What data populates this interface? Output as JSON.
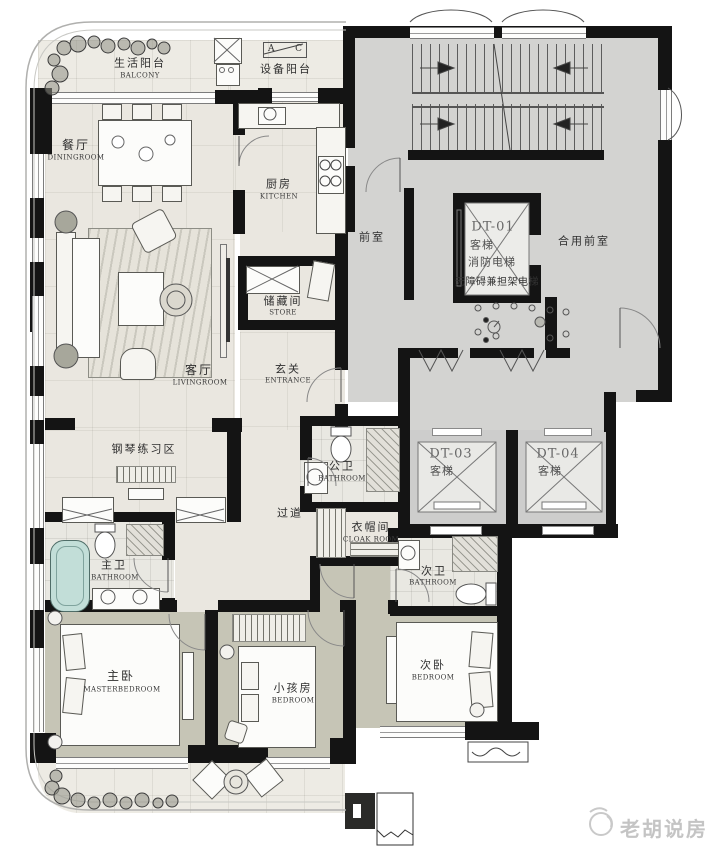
{
  "watermark": {
    "brand": "老胡说房"
  },
  "section_marker": {
    "left": "A",
    "right": "C"
  },
  "rooms": {
    "life_balcony": {
      "zh": "生活阳台",
      "en": "BALCONY"
    },
    "equipment_balcony": {
      "zh": "设备阳台"
    },
    "dining": {
      "zh": "餐厅",
      "en": "DININGROOM"
    },
    "kitchen": {
      "zh": "厨房",
      "en": "KITCHEN"
    },
    "front_room": {
      "zh": "前室"
    },
    "shared_front_room": {
      "zh": "合用前室"
    },
    "store": {
      "zh": "储藏间",
      "en": "STORE"
    },
    "living": {
      "zh": "客厅",
      "en": "LIVINGROOM"
    },
    "entrance": {
      "zh": "玄关",
      "en": "ENTRANCE"
    },
    "piano_area": {
      "zh": "钢琴练习区"
    },
    "public_bath": {
      "zh": "公卫",
      "en": "BATHROOM"
    },
    "corridor": {
      "zh": "过道"
    },
    "cloak_room": {
      "zh": "衣帽间",
      "en": "CLOAK ROOM"
    },
    "master_bath": {
      "zh": "主卫",
      "en": "BATHROOM"
    },
    "second_bath": {
      "zh": "次卫",
      "en": "BATHROOM"
    },
    "master_bedroom": {
      "zh": "主卧",
      "en": "MASTERBEDROOM"
    },
    "kids_bedroom": {
      "zh": "小孩房",
      "en": "BEDROOM"
    },
    "second_bedroom": {
      "zh": "次卧",
      "en": "BEDROOM"
    }
  },
  "elevators": {
    "dt01": {
      "id": "DT-01",
      "line1": "客梯",
      "line2": "消防电梯",
      "note": "无障碍兼担架电梯"
    },
    "dt03": {
      "id": "DT-03",
      "type": "客梯"
    },
    "dt04": {
      "id": "DT-04",
      "type": "客梯"
    }
  },
  "colors": {
    "wall": "#141414",
    "common_area": "#d3d3d1",
    "unit_floor": "#eae7e0",
    "bedroom_floor": "#c6c5b6",
    "bathtub": "#c2ded8",
    "watermark": "#c4c4c4"
  }
}
